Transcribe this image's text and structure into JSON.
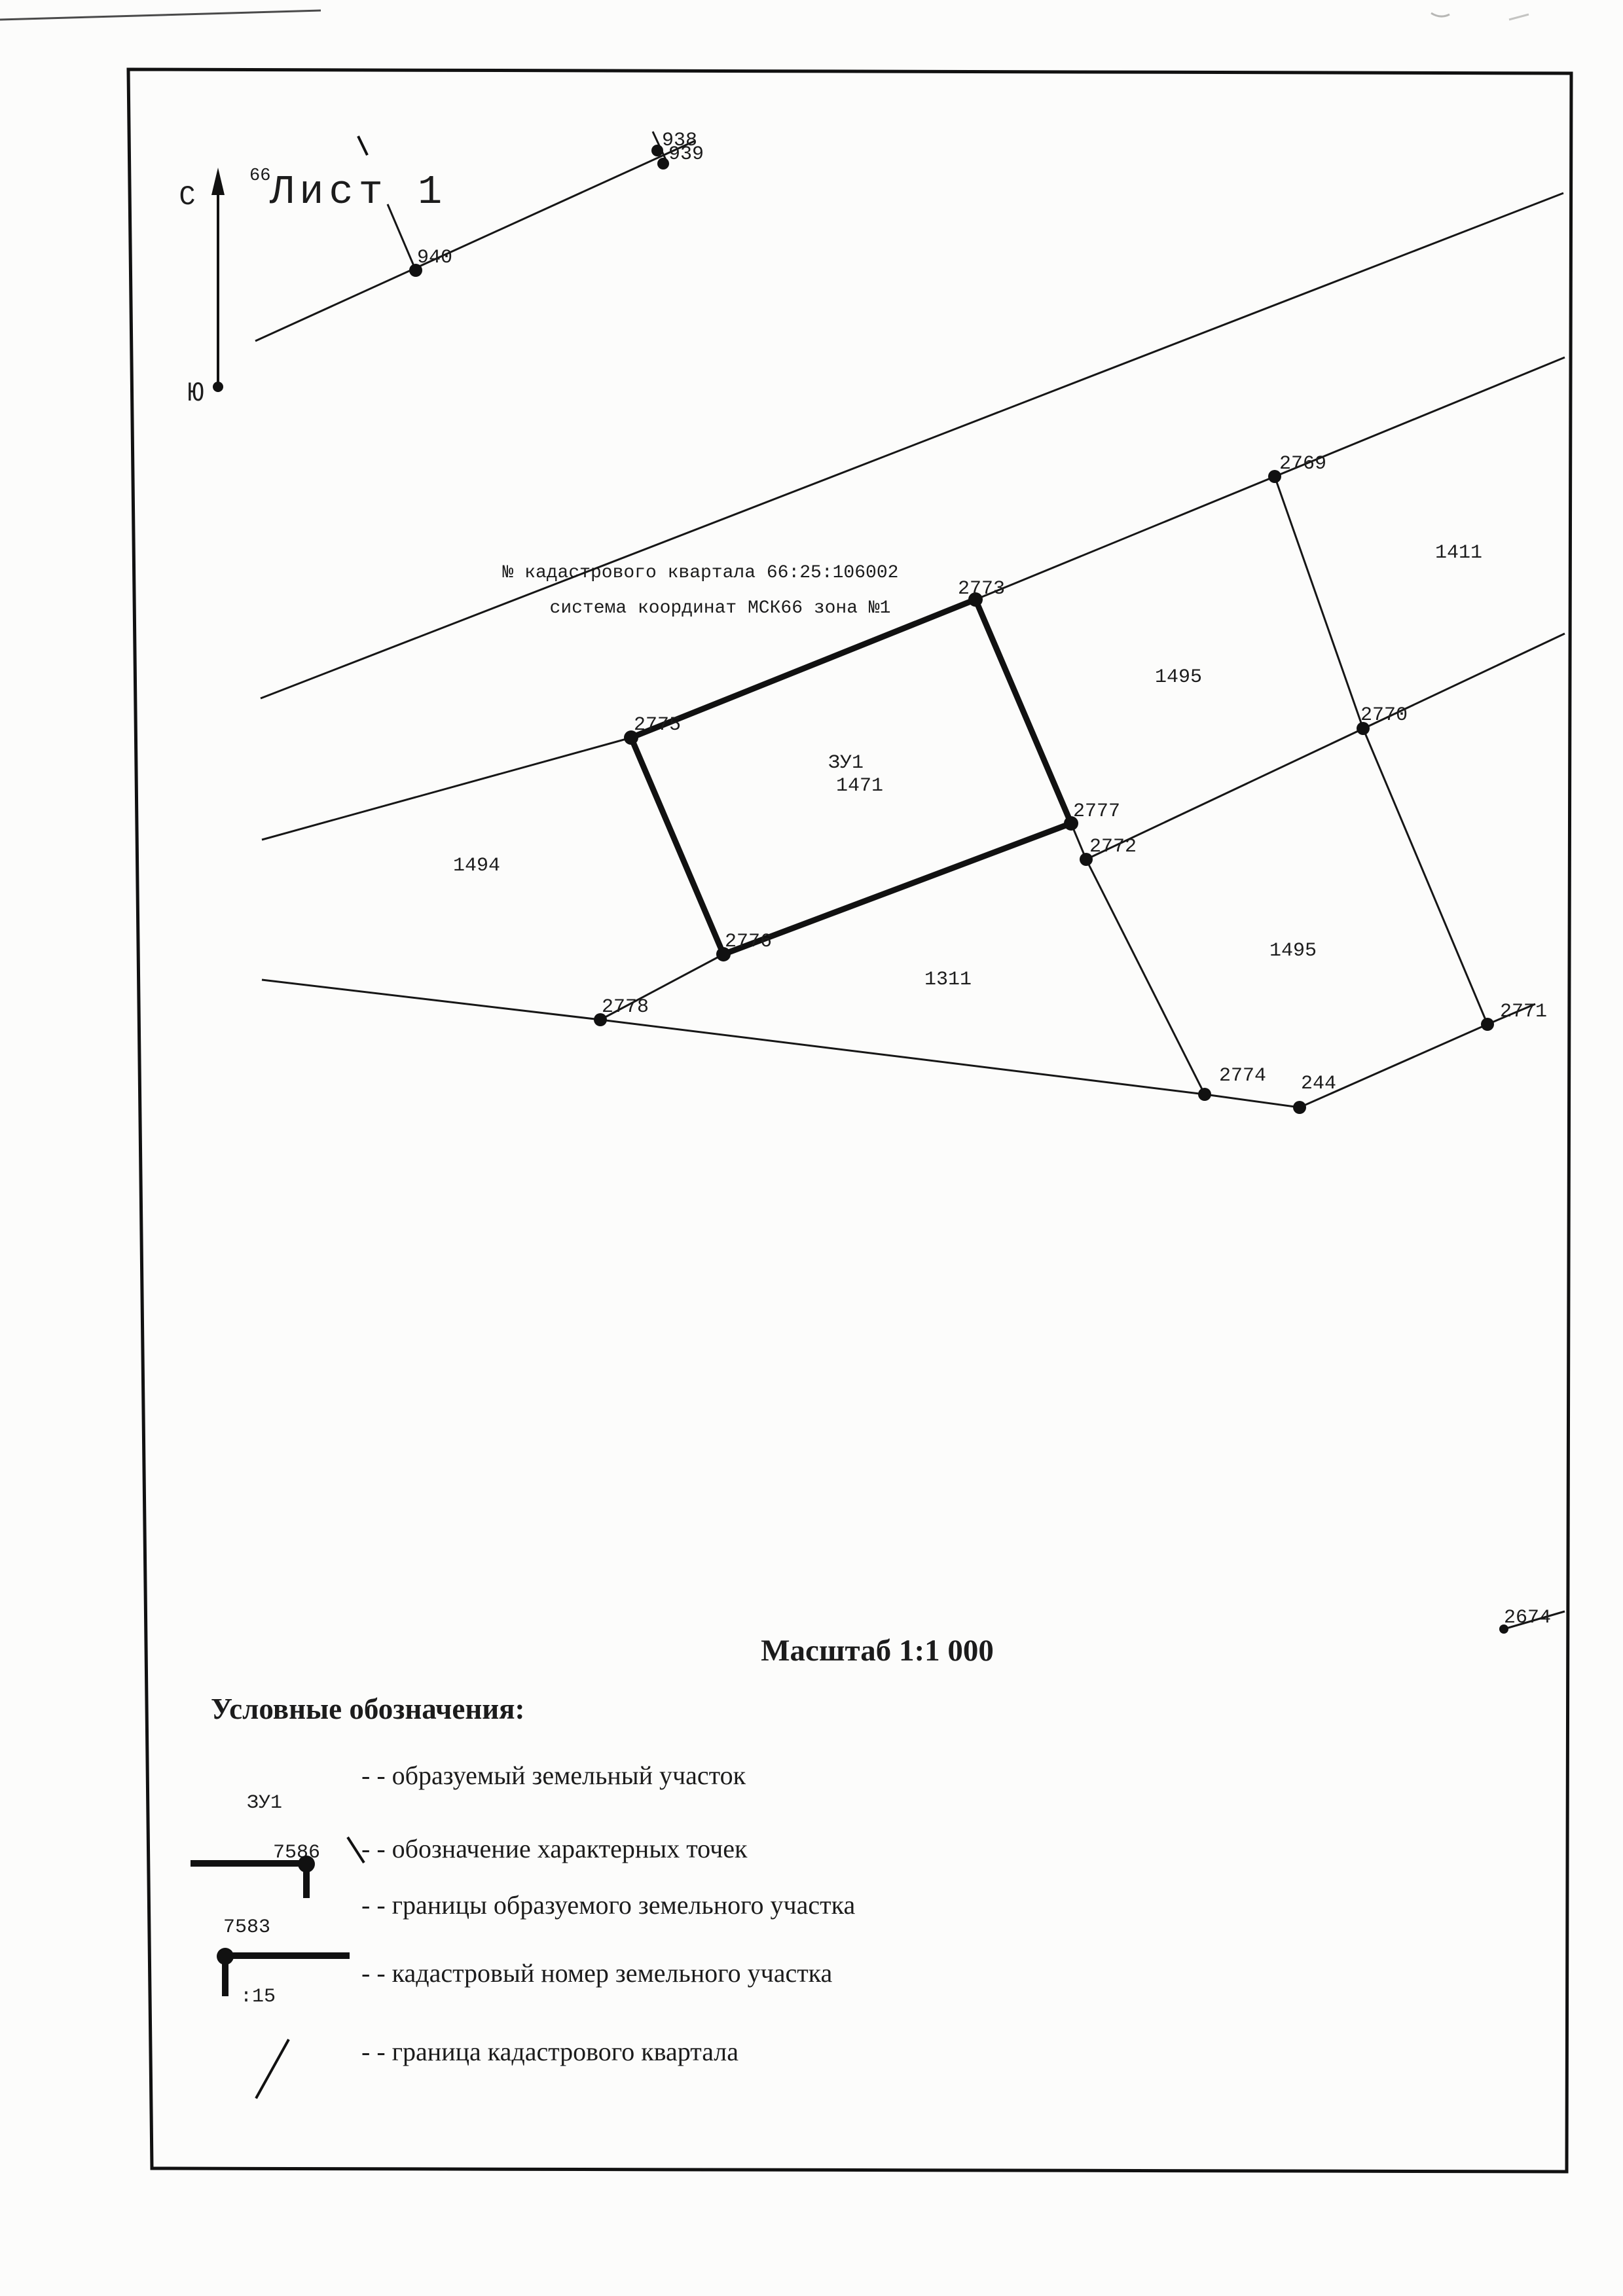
{
  "sheet": {
    "superscript": "66",
    "title": "Лист 1"
  },
  "compass": {
    "north_label": "С",
    "south_label": "Ю"
  },
  "note": {
    "line1": "№ кадастрового квартала 66:25:106002",
    "line2": "система координат МСК66 зона №1"
  },
  "parcel": {
    "name": "ЗУ1",
    "value": "1471"
  },
  "points": [
    {
      "label": "938"
    },
    {
      "label": "939"
    },
    {
      "label": "940"
    },
    {
      "label": "2773"
    },
    {
      "label": "2775"
    },
    {
      "label": "2776"
    },
    {
      "label": "2777"
    },
    {
      "label": "2772"
    },
    {
      "label": "2769"
    },
    {
      "label": "2770"
    },
    {
      "label": "2771"
    },
    {
      "label": "2778"
    },
    {
      "label": "2774"
    },
    {
      "label": "244"
    },
    {
      "label": "2674"
    }
  ],
  "region_labels": [
    {
      "text": "1411"
    },
    {
      "text": "1495"
    },
    {
      "text": "1494"
    },
    {
      "text": "1311"
    },
    {
      "text": "1495"
    }
  ],
  "scale": {
    "text": "Масштаб 1:1 000"
  },
  "legend": {
    "title": "Условные обозначения:",
    "items": [
      {
        "symbol_label": "ЗУ1",
        "text": "- - образуемый земельный участок"
      },
      {
        "symbol_label": "7586",
        "text": "- - обозначение характерных точек"
      },
      {
        "symbol_label": "7583",
        "text": "- - границы образуемого земельного участка"
      },
      {
        "symbol_label": ":15",
        "text": "- - кадастровый номер земельного участка"
      },
      {
        "symbol_label": "",
        "text": "- - граница кадастрового квартала"
      }
    ]
  }
}
